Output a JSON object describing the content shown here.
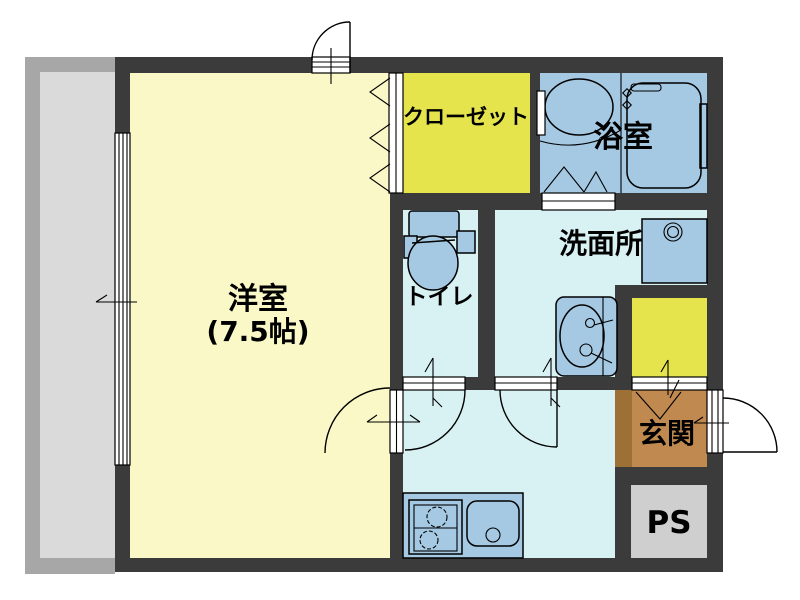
{
  "floorplan": {
    "type": "apartment-floor-plan",
    "rooms": {
      "western_room": {
        "name": "洋室",
        "size": "(7.5帖)"
      },
      "closet": {
        "name": "クローゼット"
      },
      "bathroom": {
        "name": "浴室"
      },
      "washroom": {
        "name": "洗面所"
      },
      "toilet": {
        "name": "トイレ"
      },
      "entrance": {
        "name": "玄関"
      },
      "pipe_space": {
        "name": "PS"
      }
    },
    "colors": {
      "wall": "#3b3b3b",
      "western_room_floor": "#f9f8c6",
      "closet_yellow": "#e5e44d",
      "fixture_blue": "#a5c9e3",
      "wet_area_floor": "#d8f1f3",
      "entrance_brown": "#c0894f",
      "entrance_step_brown": "#9d7136",
      "pipe_space_gray": "#cfcfcf",
      "balcony_outer_gray": "#a7a7a7",
      "balcony_inner_gray": "#dadada"
    }
  }
}
